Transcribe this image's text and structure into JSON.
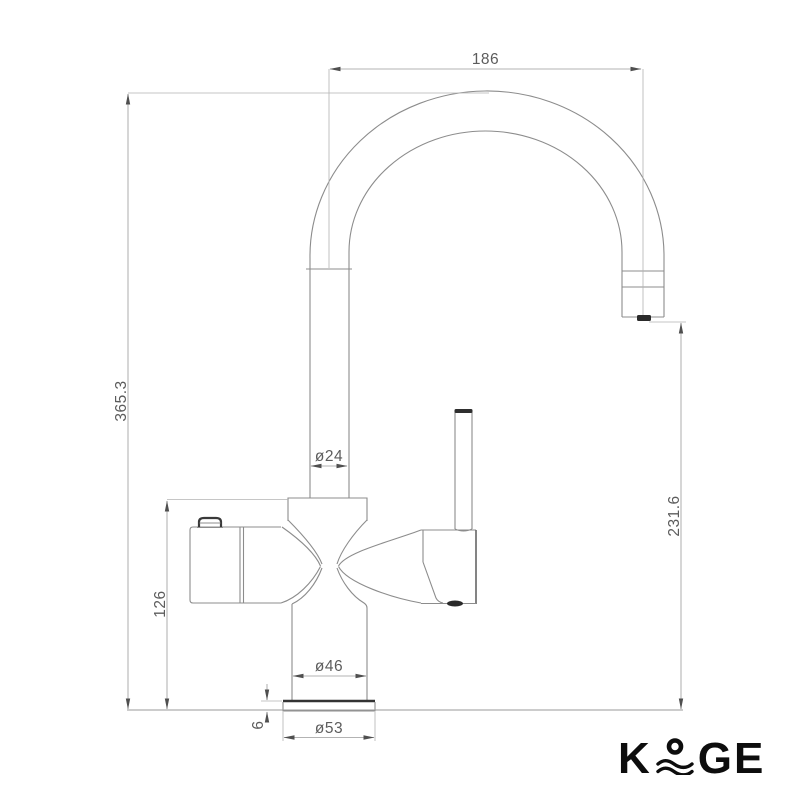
{
  "drawing": {
    "dimensions": {
      "spout_reach": {
        "label": "186"
      },
      "overall_height": {
        "label": "365.3"
      },
      "body_height": {
        "label": "126"
      },
      "outlet_height": {
        "label": "231.6"
      },
      "spout_diameter": {
        "label": "ø24"
      },
      "body_diameter": {
        "label": "ø46"
      },
      "base_diameter": {
        "label": "ø53"
      },
      "base_plate_thickness": {
        "label": "6"
      }
    },
    "colors": {
      "outline": "#8c8c8c",
      "dark_accent": "#3a3a3a",
      "dimension_text": "#5c5c5c",
      "logo": "#0d0d0d"
    }
  },
  "logo": {
    "brand": "KOGE",
    "k": "K",
    "ge": "GE"
  }
}
